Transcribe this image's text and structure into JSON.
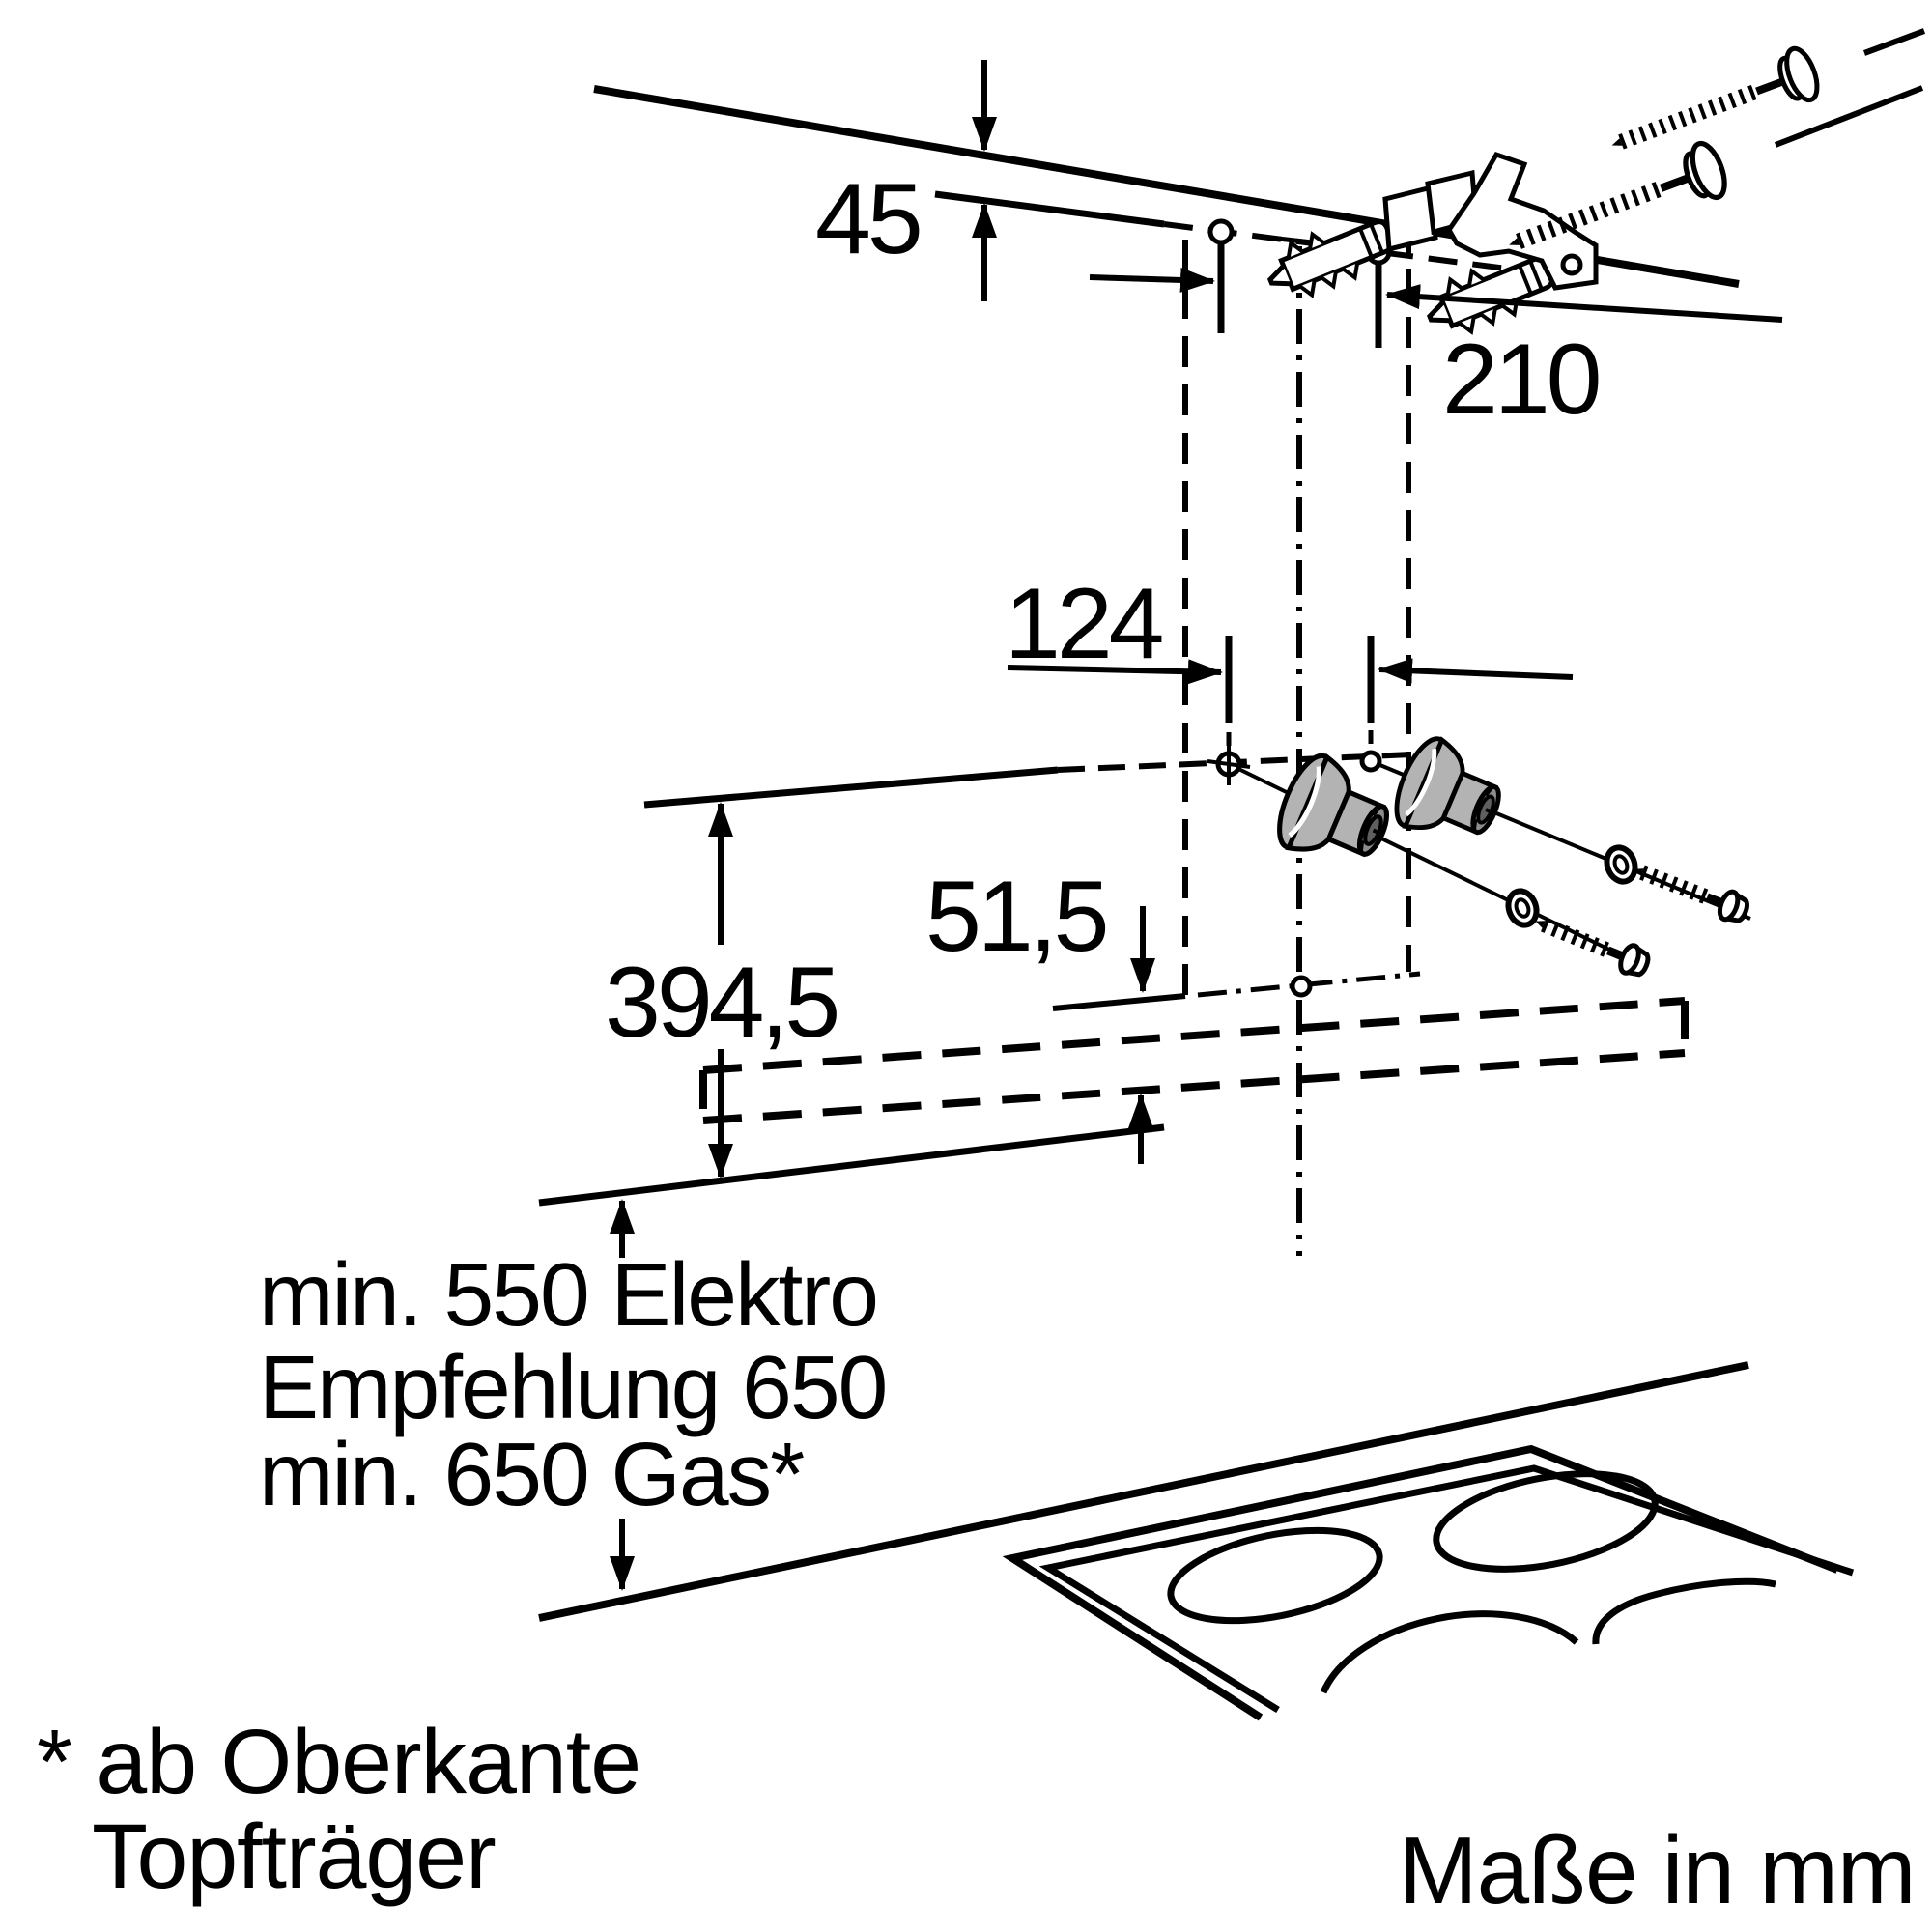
{
  "diagram": {
    "kind": "appliance-installation-dimension-drawing",
    "dimensions": {
      "d45": "45",
      "d210": "210",
      "d124": "124",
      "d394_5": "394,5",
      "d51_5": "51,5"
    },
    "clearance": {
      "line1": "min. 550 Elektro",
      "line2": "Empfehlung 650",
      "line3": "min. 650 Gas*"
    },
    "footnote": {
      "line1": "* ab Oberkante",
      "line2": "Topfträger"
    },
    "units": {
      "note": "Maße in mm"
    },
    "colors": {
      "ink": "#000000",
      "part_gray": "#b3b3b3",
      "part_gray_dark": "#8c8c8c",
      "part_gray_socket": "#5f5f5f",
      "background": "#ffffff"
    }
  }
}
